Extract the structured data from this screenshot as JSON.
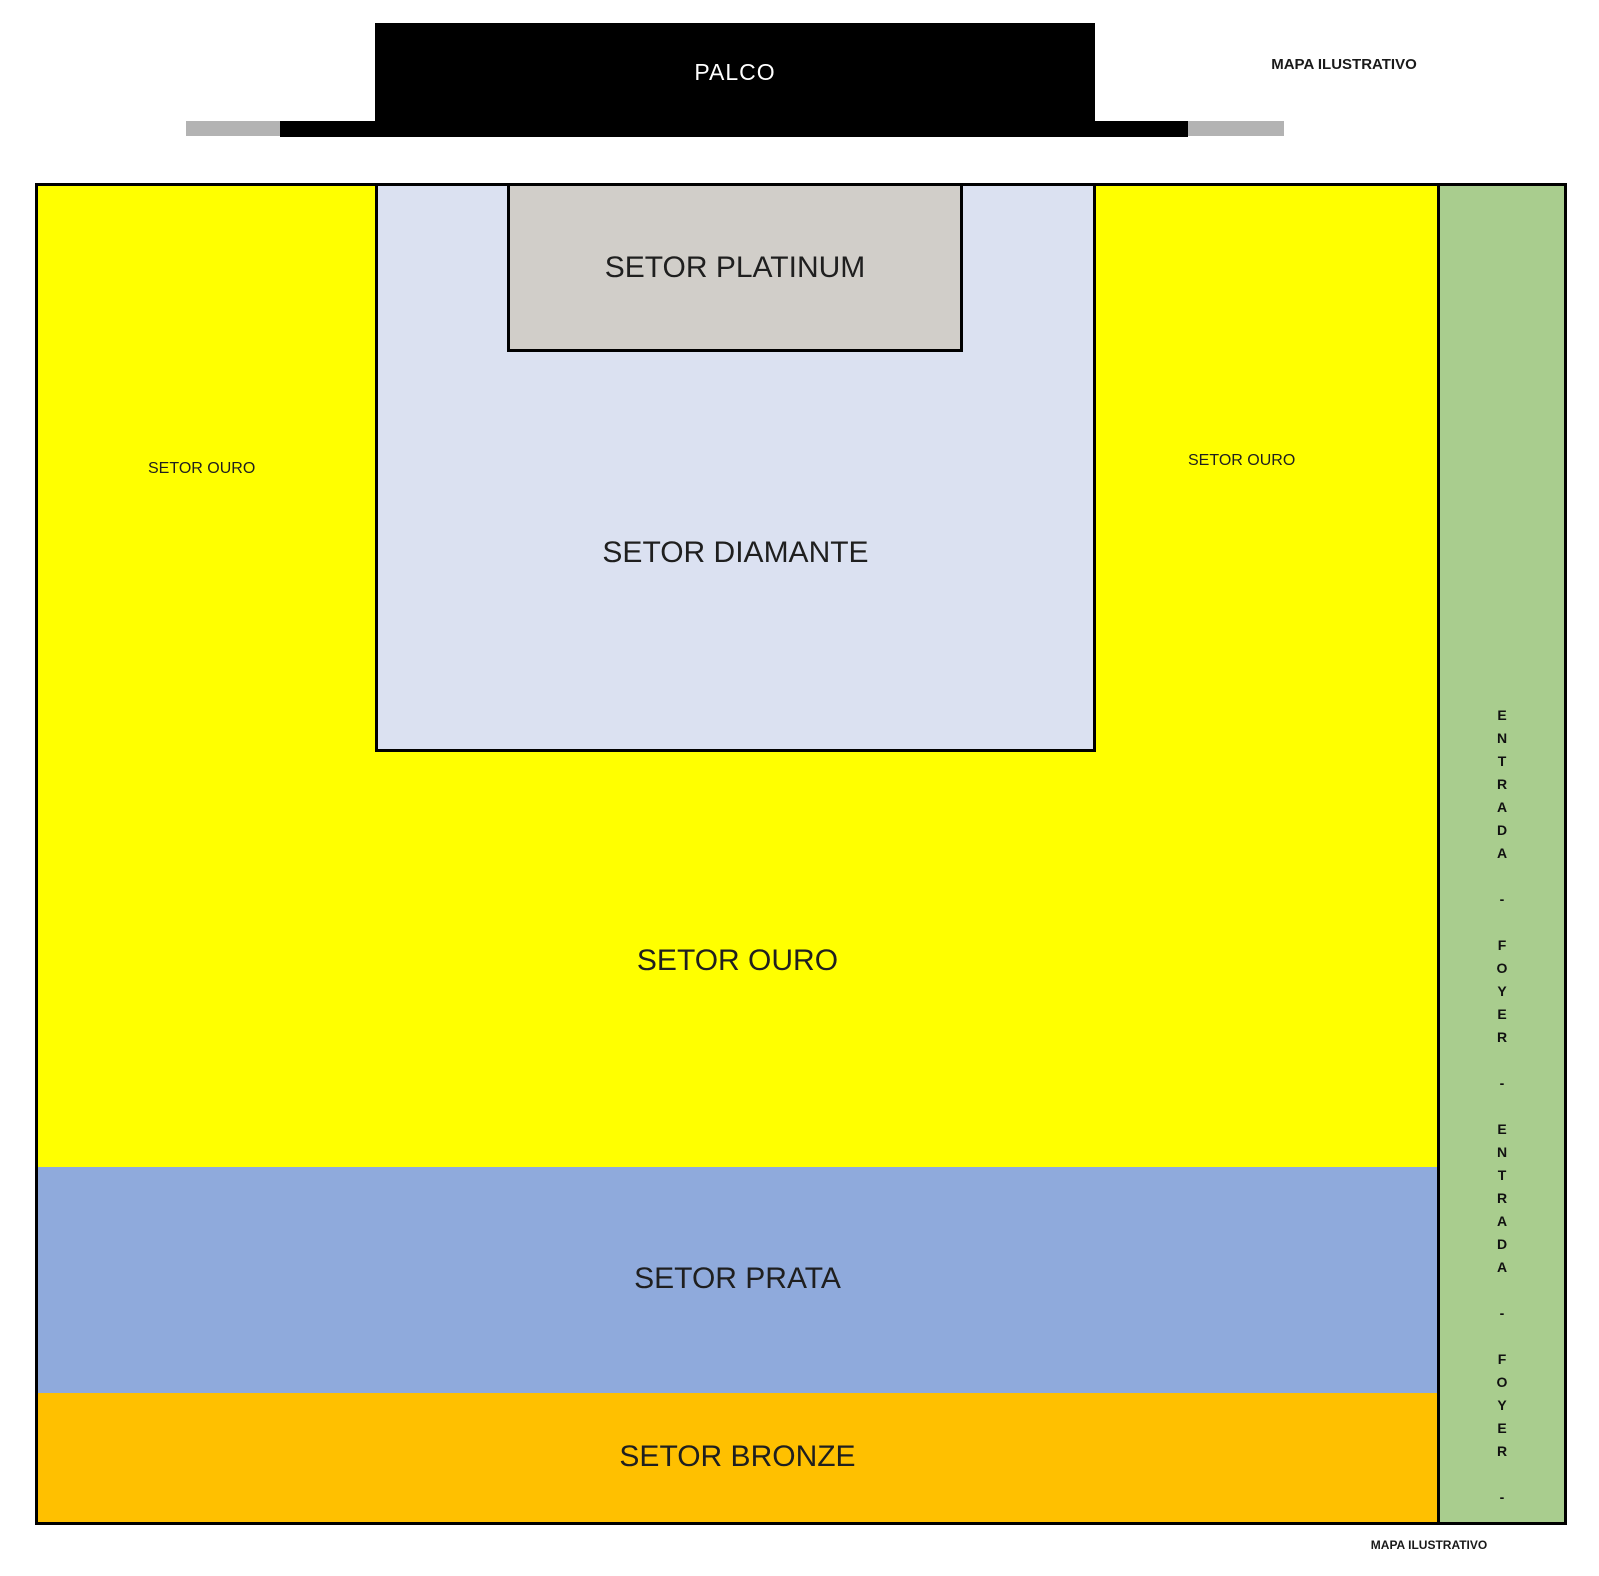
{
  "stage": {
    "label": "PALCO"
  },
  "watermarks": {
    "top": "MAPA ILUSTRATIVO",
    "bottom": "MAPA ILUSTRATIVO"
  },
  "sectors": {
    "platinum": {
      "label": "SETOR PLATINUM",
      "color": "#d1cec9"
    },
    "diamante": {
      "label": "SETOR DIAMANTE",
      "color": "#dbe1f1"
    },
    "ouro": {
      "label_center": "SETOR OURO",
      "label_left": "SETOR OURO",
      "label_right": "SETOR OURO",
      "color": "#ffff00"
    },
    "prata": {
      "label": "SETOR PRATA",
      "color": "#8faadc"
    },
    "bronze": {
      "label": "SETOR BRONZE",
      "color": "#ffc000"
    }
  },
  "entrance_strip": {
    "reading": "ENTRADA - FOYER - ENTRADA - FOYER -",
    "vertical_text": "E\nN\nT\nR\nA\nD\nA\n\n-\n\nF\nO\nY\nE\nR\n\n-\n\nE\nN\nT\nR\nA\nD\nA\n\n-\n\nF\nO\nY\nE\nR\n\n-",
    "color": "#a9cd8e"
  },
  "colors": {
    "stage": "#000000",
    "stage_wing": "#b3b3b3",
    "border": "#000000",
    "background": "#ffffff"
  }
}
